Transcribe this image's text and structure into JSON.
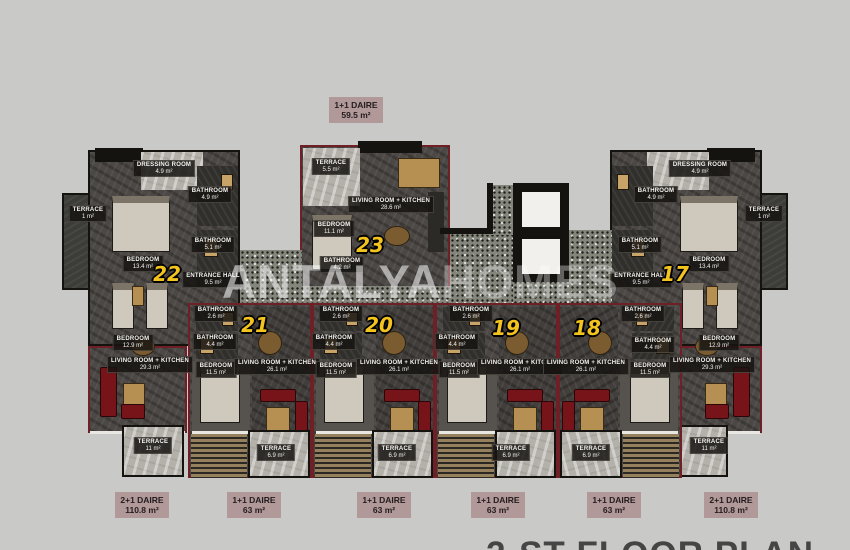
{
  "title": {
    "floor_plan_label": "2-ST FLOOR PLAN",
    "watermark_part1": "ANTALYA",
    "watermark_part2": "HOMES"
  },
  "type_labels": {
    "top": {
      "type": "1+1 DAIRE",
      "area": "59.5 m²"
    },
    "bottom": [
      {
        "type": "2+1 DAIRE",
        "area": "110.8 m²"
      },
      {
        "type": "1+1 DAIRE",
        "area": "63 m²"
      },
      {
        "type": "1+1 DAIRE",
        "area": "63 m²"
      },
      {
        "type": "1+1 DAIRE",
        "area": "63 m²"
      },
      {
        "type": "1+1 DAIRE",
        "area": "63 m²"
      },
      {
        "type": "2+1 DAIRE",
        "area": "110.8 m²"
      }
    ]
  },
  "units": {
    "u22": {
      "number": "22",
      "type": "2+1 DAIRE",
      "rooms": {
        "dressing_room": {
          "name": "DRESSING ROOM",
          "area": "4.9 m²"
        },
        "bathroom_1": {
          "name": "BATHROOM",
          "area": "4.9 m²"
        },
        "terrace_side": {
          "name": "TERRACE",
          "area": "1 m²"
        },
        "bedroom_1": {
          "name": "BEDROOM",
          "area": "13.4 m²"
        },
        "bathroom_2": {
          "name": "BATHROOM",
          "area": "5.1 m²"
        },
        "bedroom_2": {
          "name": "BEDROOM",
          "area": "12.9 m²"
        },
        "entrance_hall": {
          "name": "ENTRANCE HALL",
          "area": "9.5 m²"
        },
        "living": {
          "name": "LIVING ROOM + KITCHEN",
          "area": "29.3 m²"
        },
        "terrace": {
          "name": "TERRACE",
          "area": "11 m²"
        }
      }
    },
    "u23": {
      "number": "23",
      "type": "1+1 DAIRE",
      "rooms": {
        "terrace": {
          "name": "TERRACE",
          "area": "5.5 m²"
        },
        "living": {
          "name": "LIVING ROOM + KITCHEN",
          "area": "28.6 m²"
        },
        "bedroom": {
          "name": "BEDROOM",
          "area": "11.1 m²"
        },
        "bathroom": {
          "name": "BATHROOM",
          "area": "4.2 m²"
        }
      }
    },
    "u21": {
      "number": "21",
      "type": "1+1 DAIRE",
      "rooms": {
        "wc": {
          "name": "BATHROOM",
          "area": "2.6 m²"
        },
        "bathroom": {
          "name": "BATHROOM",
          "area": "4.4 m²"
        },
        "bedroom": {
          "name": "BEDROOM",
          "area": "11.5 m²"
        },
        "living": {
          "name": "LIVING ROOM + KITCHEN",
          "area": "26.1 m²"
        },
        "terrace": {
          "name": "TERRACE",
          "area": "6.9 m²"
        }
      }
    },
    "u20": {
      "number": "20",
      "type": "1+1 DAIRE",
      "rooms": {
        "wc": {
          "name": "BATHROOM",
          "area": "2.6 m²"
        },
        "bathroom": {
          "name": "BATHROOM",
          "area": "4.4 m²"
        },
        "bedroom": {
          "name": "BEDROOM",
          "area": "11.5 m²"
        },
        "living": {
          "name": "LIVING ROOM + KITCHEN",
          "area": "26.1 m²"
        },
        "terrace": {
          "name": "TERRACE",
          "area": "6.9 m²"
        }
      }
    },
    "u19": {
      "number": "19",
      "type": "1+1 DAIRE",
      "rooms": {
        "wc": {
          "name": "BATHROOM",
          "area": "2.6 m²"
        },
        "bathroom": {
          "name": "BATHROOM",
          "area": "4.4 m²"
        },
        "bedroom": {
          "name": "BEDROOM",
          "area": "11.5 m²"
        },
        "living": {
          "name": "LIVING ROOM + KITCHEN",
          "area": "26.1 m²"
        },
        "terrace": {
          "name": "TERRACE",
          "area": "6.9 m²"
        }
      }
    },
    "u18": {
      "number": "18",
      "type": "1+1 DAIRE",
      "rooms": {
        "wc": {
          "name": "BATHROOM",
          "area": "2.6 m²"
        },
        "bathroom": {
          "name": "BATHROOM",
          "area": "4.4 m²"
        },
        "bedroom": {
          "name": "BEDROOM",
          "area": "11.5 m²"
        },
        "living": {
          "name": "LIVING ROOM + KITCHEN",
          "area": "26.1 m²"
        },
        "terrace": {
          "name": "TERRACE",
          "area": "6.9 m²"
        }
      }
    },
    "u17": {
      "number": "17",
      "type": "2+1 DAIRE",
      "rooms": {
        "dressing_room": {
          "name": "DRESSING ROOM",
          "area": "4.9 m²"
        },
        "bathroom_1": {
          "name": "BATHROOM",
          "area": "4.9 m²"
        },
        "terrace_side": {
          "name": "TERRACE",
          "area": "1 m²"
        },
        "bedroom_1": {
          "name": "BEDROOM",
          "area": "13.4 m²"
        },
        "bathroom_2": {
          "name": "BATHROOM",
          "area": "5.1 m²"
        },
        "bedroom_2": {
          "name": "BEDROOM",
          "area": "12.9 m²"
        },
        "entrance_hall": {
          "name": "ENTRANCE HALL",
          "area": "9.5 m²"
        },
        "living": {
          "name": "LIVING ROOM + KITCHEN",
          "area": "29.3 m²"
        },
        "terrace": {
          "name": "TERRACE",
          "area": "11 m²"
        }
      }
    }
  },
  "colors": {
    "background": "#c9c9c7",
    "wall_red": "#6f2026",
    "wall_black": "#15130f",
    "badge_yellow": "#f4c41e",
    "type_label_bg": "#b19899",
    "label_bg": "#161412"
  }
}
